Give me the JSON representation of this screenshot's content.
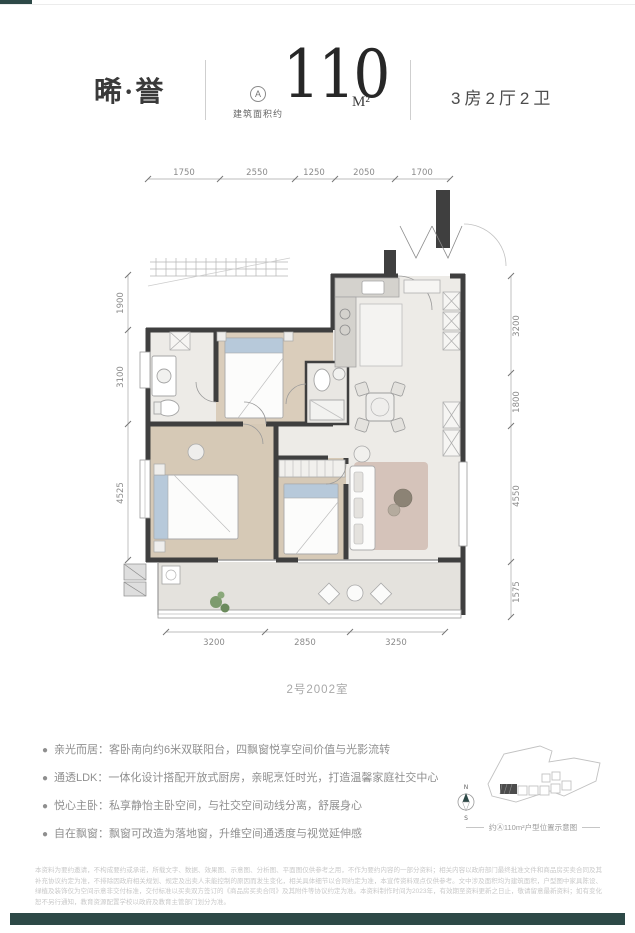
{
  "header": {
    "project_name": "晞·誉",
    "unit_badge": "A",
    "area_prefix": "建筑面积约",
    "area_value": "110",
    "area_unit": "M²",
    "layout_label": "3房2厅2卫"
  },
  "plan": {
    "caption": "2号2002室",
    "dims_top": [
      "1750",
      "2550",
      "1250",
      "2050",
      "1700"
    ],
    "dims_left": [
      "1900",
      "3100",
      "4525"
    ],
    "dims_right": [
      "3200",
      "1800",
      "4550",
      "1575"
    ],
    "dims_bottom": [
      "3200",
      "2850",
      "3250"
    ]
  },
  "features": [
    {
      "label": "亲光而居：",
      "desc": "客卧南向约6米双联阳台，四飘窗悦享空间价值与光影流转"
    },
    {
      "label": "通透LDK：",
      "desc": "一体化设计搭配开放式厨房，亲昵烹饪时光，打造温馨家庭社交中心"
    },
    {
      "label": "悦心主卧：",
      "desc": "私享静怡主卧空间，与社交空间动线分离，舒展身心"
    },
    {
      "label": "自在飘窗：",
      "desc": "飘窗可改造为落地窗，升维空间通透度与视觉延伸感"
    }
  ],
  "sitemap": {
    "compass_north": "N",
    "compass_south": "S",
    "caption": "约Ⓐ110m²户型位置示意图"
  },
  "legal": {
    "disclaimer": "本资料为要约邀请，不构成要约或承诺，所载文字、数据、效果图、示意图、分析图、平面图仅供参考之用，不作为要约内容的一部分资料；相关内容以政府部门最终批准文件和商品房买卖合同及其补充协议约定为准，不排除因政府相关规划、规定及出卖人未能控制的原因而发生变化，相关具体细节以合同约定为准，本宣传资料观点仅供参考。文中涉及面积均为建筑面积，户型图中家具陈设、绿植及装饰仅为空间示意非交付标准，交付标准以买卖双方签订的《商品房买卖合同》及其附件等协议约定为准。本资料制作时间为2023年，有效期至资料更新之日止，敬请留意最新资料；如有变化恕不另行通知，教育资源配置学校以政府及教育主管部门划分为准。"
  },
  "colors": {
    "accent": "#2d4947"
  }
}
